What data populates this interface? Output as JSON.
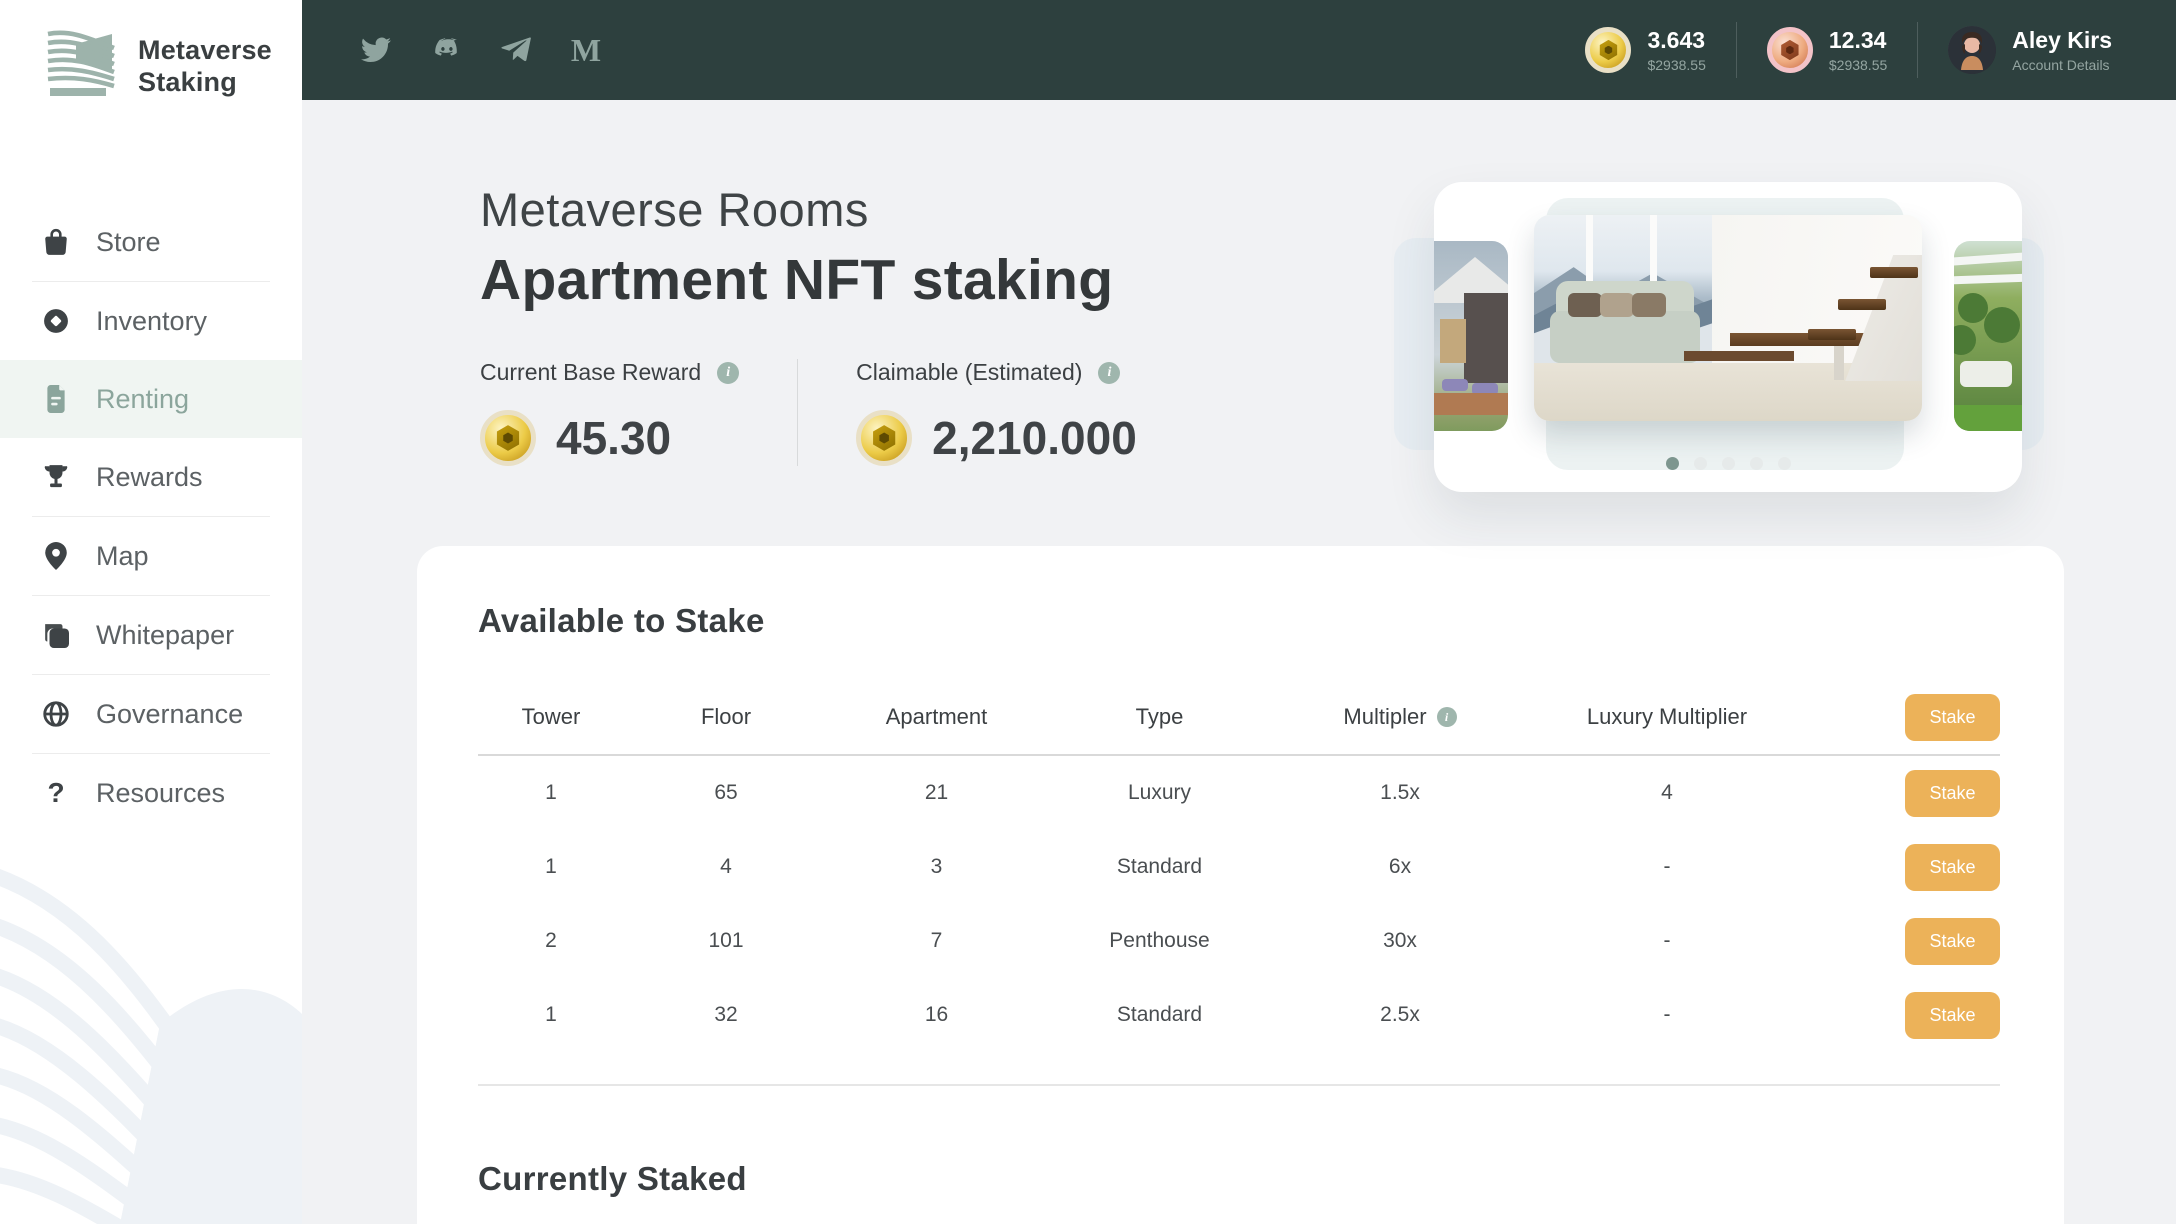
{
  "colors": {
    "accent_sage": "#8BA59C",
    "topbar": "#2D403E",
    "stake_button": "#ECB259",
    "active_nav_bg": "#F0F5F2"
  },
  "sidebar": {
    "logo": {
      "line1": "Metaverse",
      "line2": "Staking"
    },
    "items": [
      {
        "label": "Store",
        "icon": "shopping-bag-icon"
      },
      {
        "label": "Inventory",
        "icon": "inventory-token-icon"
      },
      {
        "label": "Renting",
        "icon": "document-icon",
        "active": true
      },
      {
        "label": "Rewards",
        "icon": "trophy-icon"
      },
      {
        "label": "Map",
        "icon": "map-pin-icon"
      },
      {
        "label": "Whitepaper",
        "icon": "copy-pages-icon"
      },
      {
        "label": "Governance",
        "icon": "globe-icon"
      },
      {
        "label": "Resources",
        "icon": "question-mark-icon",
        "question_glyph": "?"
      }
    ]
  },
  "topbar": {
    "social": [
      "twitter-icon",
      "discord-icon",
      "telegram-icon",
      "medium-icon"
    ],
    "medium_glyph": "M",
    "balances": [
      {
        "amount": "3.643",
        "usd": "$2938.55",
        "coin": "gold"
      },
      {
        "amount": "12.34",
        "usd": "$2938.55",
        "coin": "pink"
      }
    ],
    "account": {
      "name": "Aley Kirs",
      "subtitle": "Account Details"
    }
  },
  "hero": {
    "subtitle": "Metaverse Rooms",
    "title": "Apartment NFT staking",
    "stats": [
      {
        "label": "Current Base Reward",
        "value": "45.30"
      },
      {
        "label": "Claimable (Estimated)",
        "value": "2,210.000"
      }
    ],
    "carousel": {
      "dot_count": 5,
      "active_dot_index": 0
    }
  },
  "staking": {
    "available_title": "Available to Stake",
    "columns": [
      "Tower",
      "Floor",
      "Apartment",
      "Type",
      "Multipler",
      "Luxury Multiplier"
    ],
    "stake_label": "Stake",
    "rows": [
      {
        "tower": "1",
        "floor": "65",
        "apartment": "21",
        "type": "Luxury",
        "multiplier": "1.5x",
        "luxury_multiplier": "4"
      },
      {
        "tower": "1",
        "floor": "4",
        "apartment": "3",
        "type": "Standard",
        "multiplier": "6x",
        "luxury_multiplier": "-"
      },
      {
        "tower": "2",
        "floor": "101",
        "apartment": "7",
        "type": "Penthouse",
        "multiplier": "30x",
        "luxury_multiplier": "-"
      },
      {
        "tower": "1",
        "floor": "32",
        "apartment": "16",
        "type": "Standard",
        "multiplier": "2.5x",
        "luxury_multiplier": "-"
      }
    ],
    "staked_title": "Currently Staked"
  }
}
